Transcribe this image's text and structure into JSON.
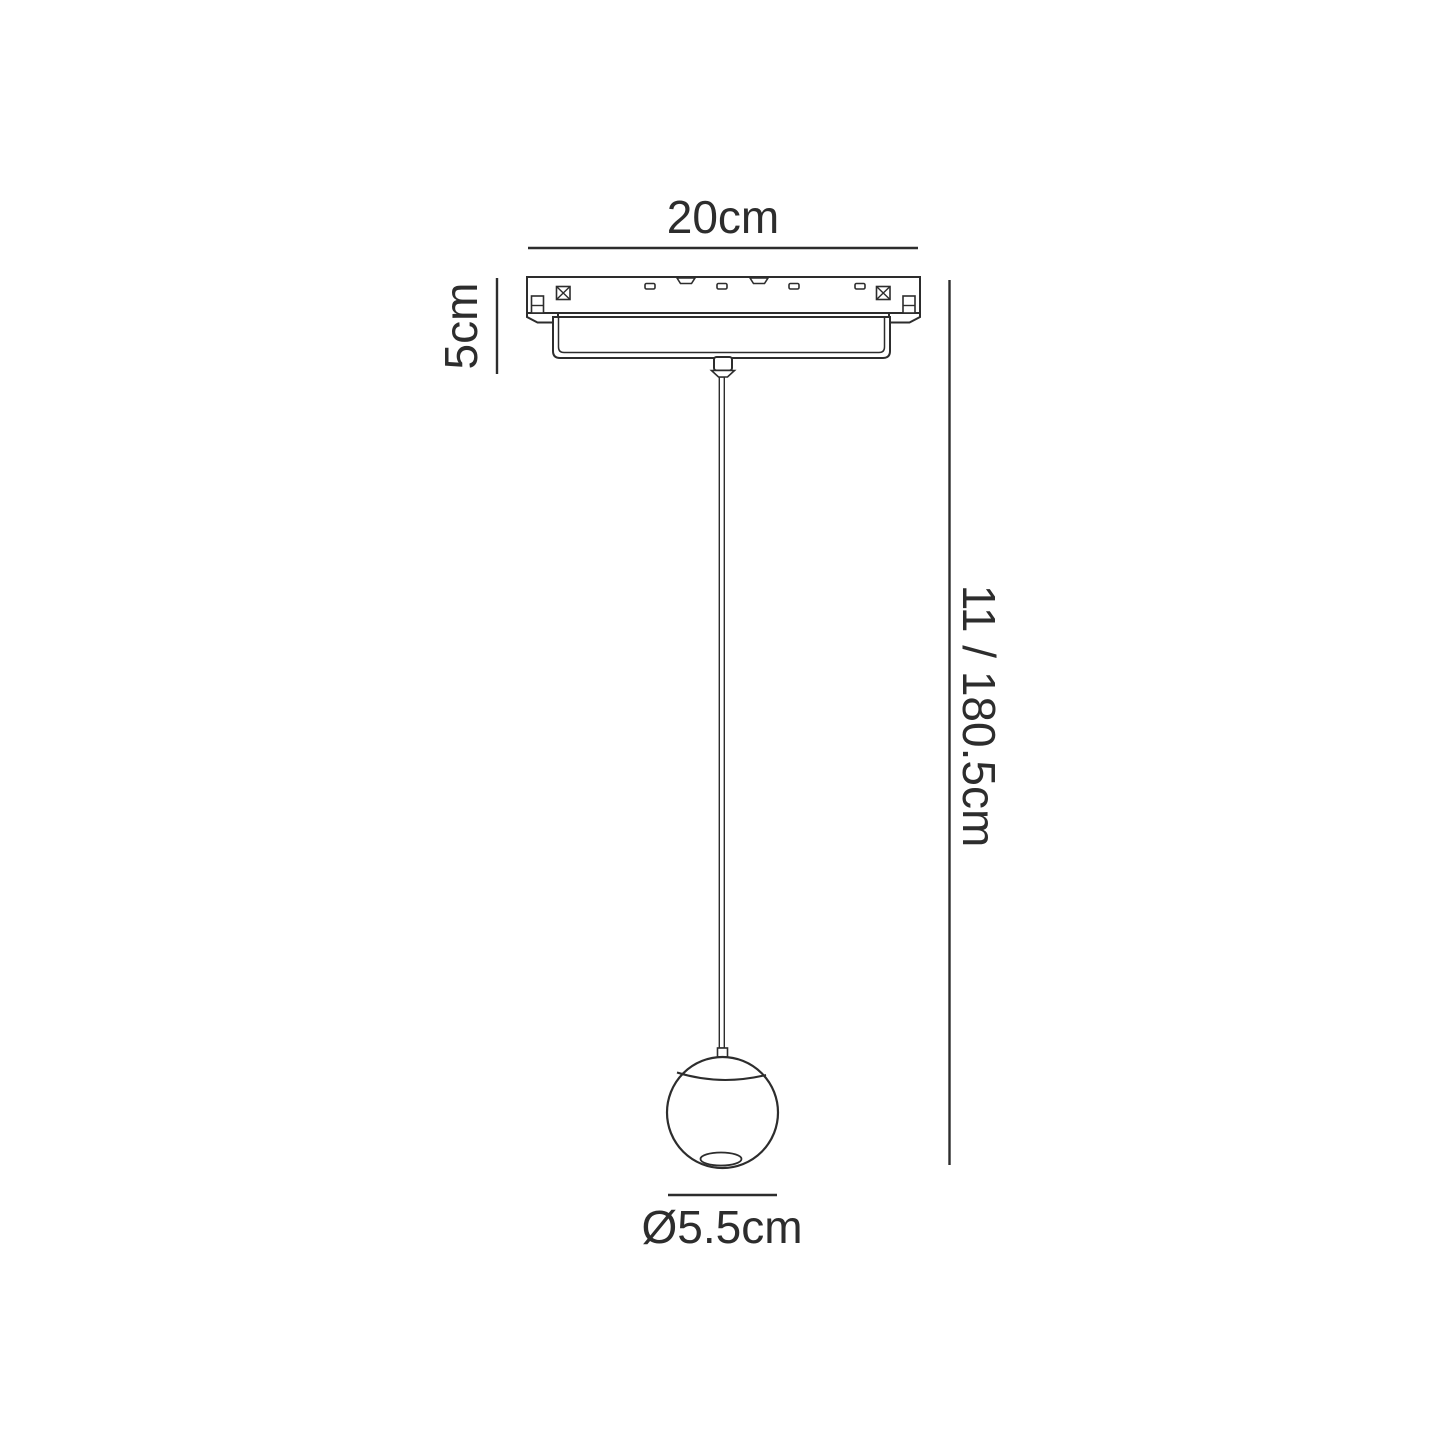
{
  "diagram": {
    "background_color": "#ffffff",
    "line_color": "#2d2d2d",
    "text_color": "#2d2d2d",
    "dimensions": {
      "track_width_label": "20cm",
      "track_height_label": "5cm",
      "drop_height_label": "11 / 180.5cm",
      "shade_diameter_label": "Ø5.5cm"
    }
  }
}
